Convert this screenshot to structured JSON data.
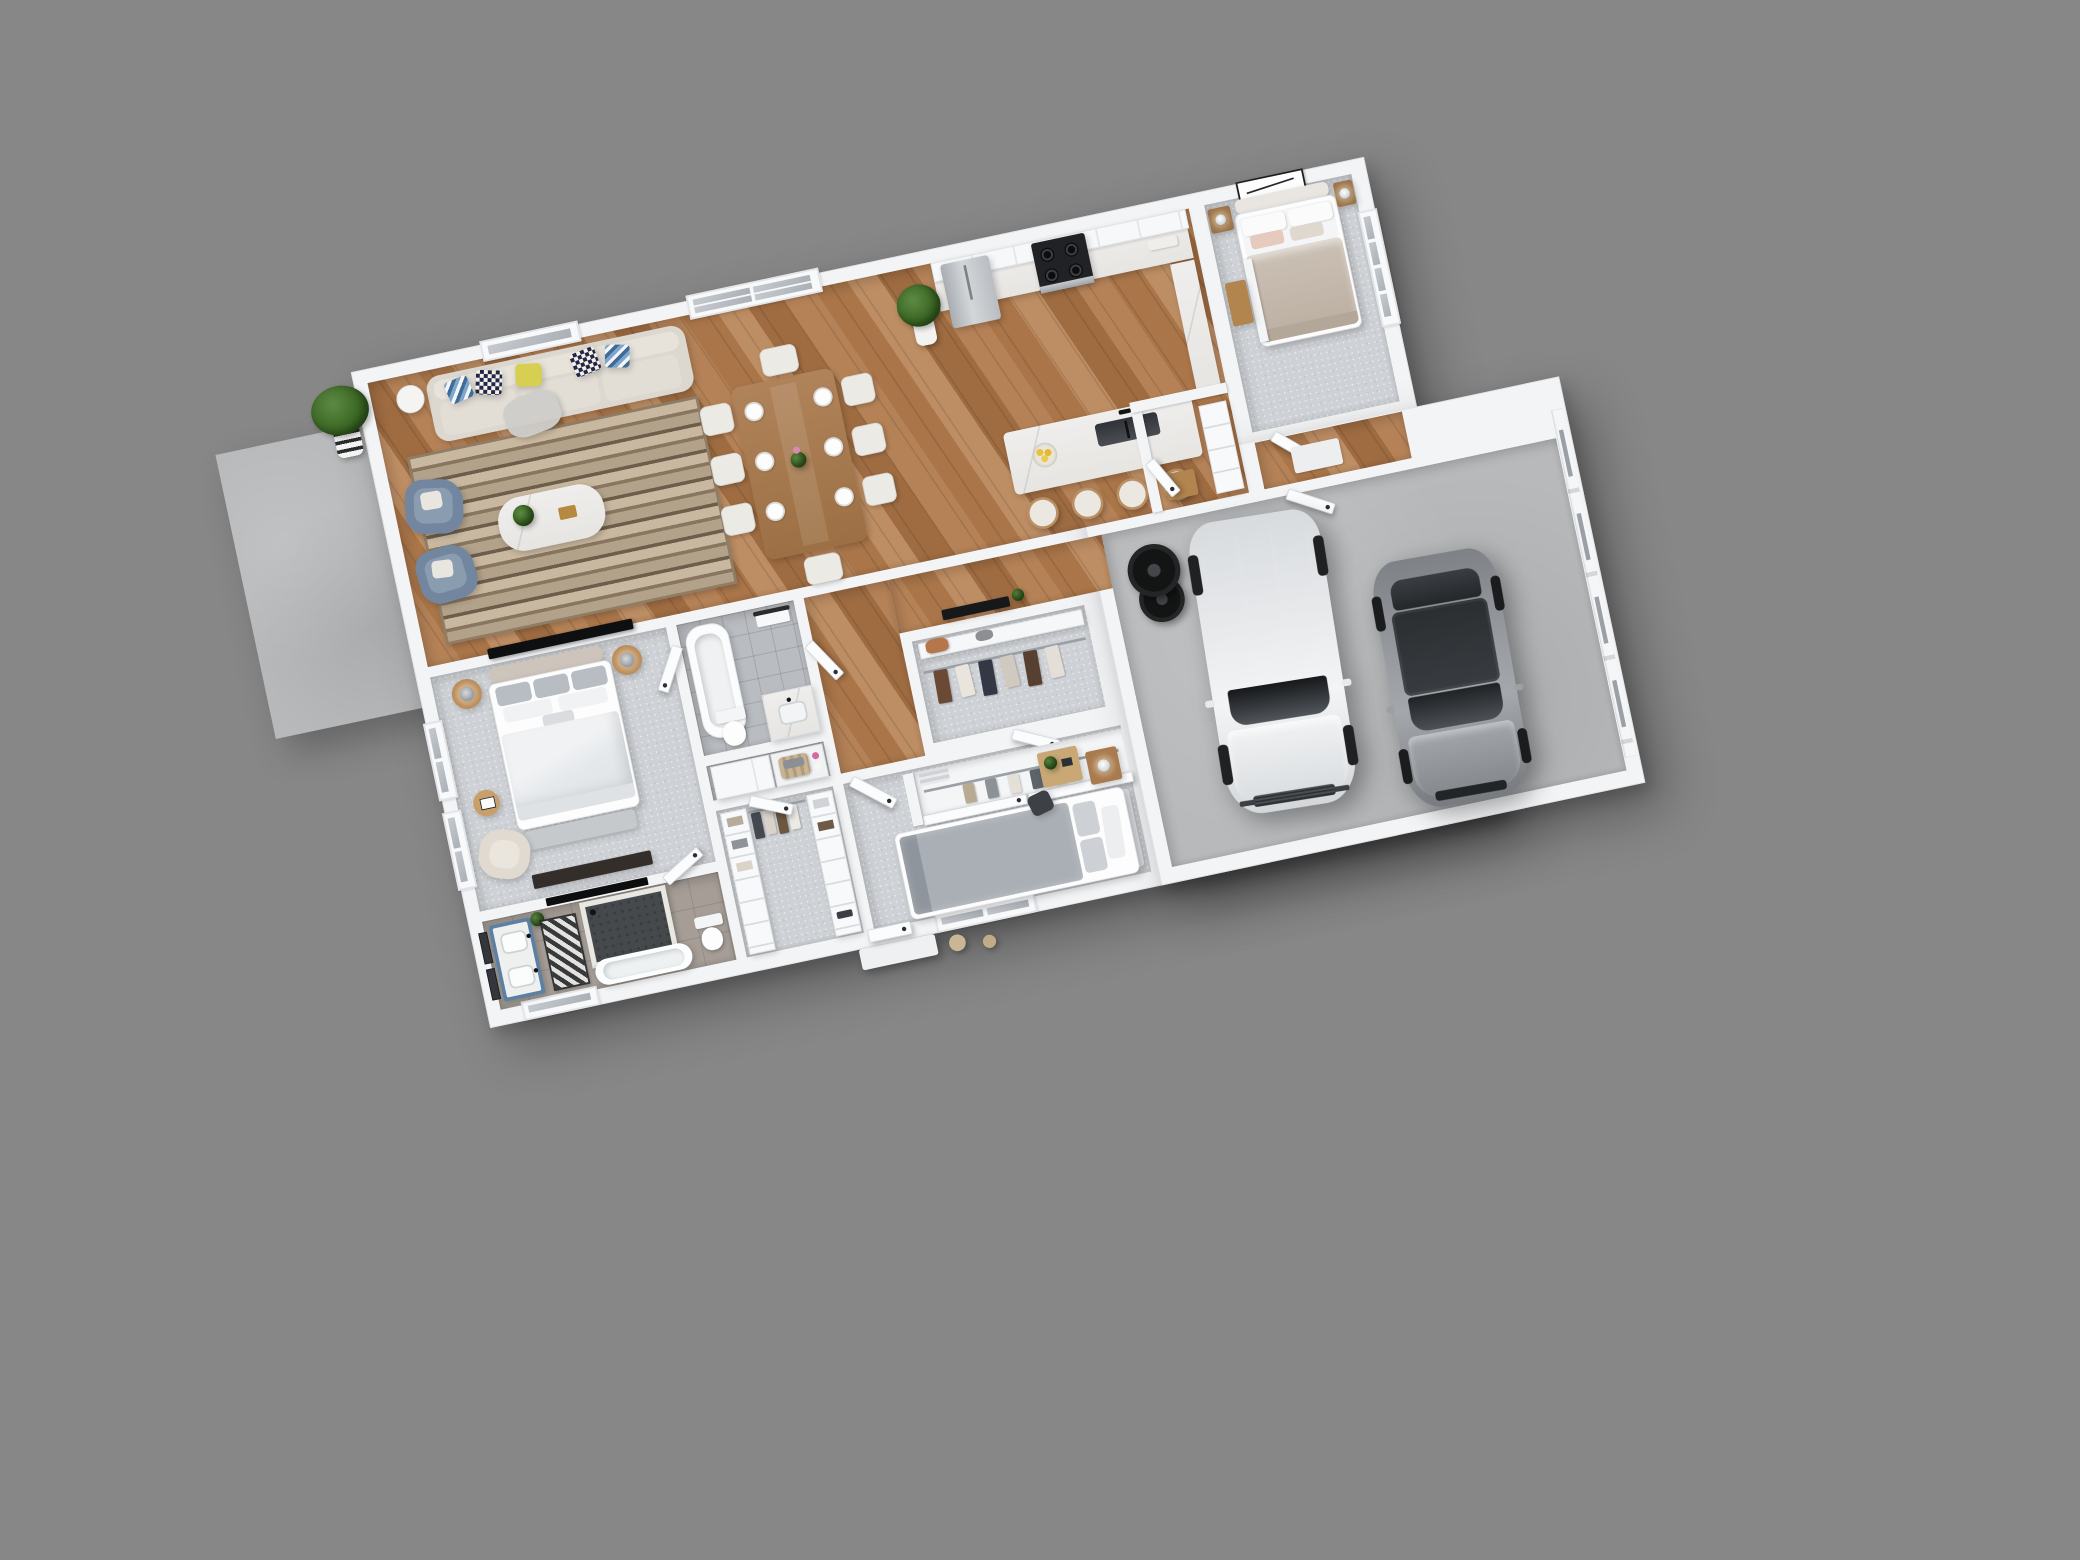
{
  "scene": {
    "type": "3d-floor-plan-render",
    "description": "Photoreal 3D dollhouse floor plan of a single-story 3-bedroom house with attached 2-car garage, viewed from above at a slight counter-clockwise rotation on a plain gray backdrop",
    "rotation_deg": -12,
    "visible_text": ""
  },
  "palette": {
    "background": "#878787",
    "wall": "#f3f4f6",
    "carpet": "#ced1d5",
    "concrete": "#b7b9bb",
    "tile_gray": "#b9bcc0",
    "tile_warm": "#a59d96",
    "wood_floor": "#ad7a4f",
    "marble": "#edecec",
    "sofa_beige": "#dcd8d0",
    "armchair_blue": "#72879f",
    "vanity_blue": "#5c80a4",
    "dining_wood": "#a87c50",
    "pillow_yellow": "#d6cf52",
    "pillow_navy": "#20264a",
    "duvet_beige": "#cbc0b4",
    "duvet_gray": "#a9afb5",
    "suv_white": "#e9ebed",
    "suv_roof_black": "#17181a",
    "sedan_gray": "#96999d"
  },
  "rooms": {
    "patio": {
      "name": "Concrete patio",
      "floor": "concrete"
    },
    "living_room": {
      "name": "Living room",
      "floor": "hardwood"
    },
    "dining_area": {
      "name": "Dining area",
      "floor": "hardwood"
    },
    "kitchen": {
      "name": "Kitchen",
      "floor": "hardwood"
    },
    "pantry": {
      "name": "Pantry / mudroom",
      "floor": "hardwood"
    },
    "bedroom_2": {
      "name": "Bedroom 2",
      "floor": "carpet"
    },
    "entry_hall": {
      "name": "Garage entry hall",
      "floor": "hardwood"
    },
    "hallway": {
      "name": "Hallway",
      "floor": "hardwood"
    },
    "hall_bathroom": {
      "name": "Hall bathroom",
      "floor": "gray tile"
    },
    "coat_closet": {
      "name": "Coat closet",
      "floor": "carpet"
    },
    "laundry_nook": {
      "name": "Laundry nook",
      "floor": "gray tile"
    },
    "master_bedroom": {
      "name": "Master bedroom",
      "floor": "carpet"
    },
    "master_bathroom": {
      "name": "Master bathroom",
      "floor": "warm tile"
    },
    "walk_in_closet": {
      "name": "Walk-in closet",
      "floor": "carpet"
    },
    "bedroom_3": {
      "name": "Bedroom 3",
      "floor": "carpet"
    },
    "garage": {
      "name": "Two-car garage",
      "floor": "concrete"
    }
  },
  "furniture": {
    "living_room": [
      "beige 3-seat sofa with yellow, checkered and zigzag pillows",
      "gray throw blanket",
      "two slate-blue armchairs with white pillows",
      "white marble coffee table with plant and gold box",
      "brown striped area rug",
      "white drum side table",
      "wall-mounted TV",
      "potted plant in striped pot on patio corner"
    ],
    "dining_area": [
      "rectangular wood dining table",
      "8 white upholstered chairs",
      "white place-setting plates",
      "flower vase"
    ],
    "kitchen": [
      "white shaker cabinet run with upper cabinets",
      "stainless french-door refrigerator",
      "stainless gas range with oven",
      "white marble countertops",
      "canister set",
      "marble waterfall island with double sink and black faucet",
      "bowl of lemons",
      "4 white bar stools with wood legs",
      "fiddle-leaf fig plant"
    ],
    "pantry": [
      "white cubby shelving",
      "wood bench"
    ],
    "bedroom_2": [
      "queen bed with beige duvet and blush pillows",
      "two wood nightstands with lamps",
      "black-framed wall art",
      "4-pane window",
      "closet nook with wood bench"
    ],
    "hall_bathroom": [
      "alcove bathtub",
      "towel bar with white towel",
      "white vanity with sink",
      "toilet"
    ],
    "coat_closet": [
      "top shelf with brown purse",
      "hanging rod with coats and shirts"
    ],
    "laundry_nook": [
      "white storage cabinet",
      "counter with woven laundry basket",
      "pink detergent bottle"
    ],
    "hallway": [
      "black console table with plant"
    ],
    "master_bedroom": [
      "king bed with white duvet and gray pillows",
      "upholstered headboard",
      "two round wood nightstands with gray lamps",
      "foot-of-bed bench",
      "dark media dresser with TV",
      "cream armchair",
      "round wood side table with book",
      "two left-wall windows"
    ],
    "master_bathroom": [
      "blue double vanity with white top, two sinks and black faucets",
      "two dark-framed mirrors",
      "walk-in marble shower with dark hex tile",
      "freestanding white tub",
      "toilet",
      "black-and-white patterned runner rug",
      "small plant"
    ],
    "walk_in_closet": [
      "two white shelving towers with folded clothes",
      "center hanging rod with garments",
      "shoes"
    ],
    "bedroom_3": [
      "queen bed with gray duvet",
      "sliding-door closet with hanging clothes and towel shelf",
      "wood nightstand with lamp",
      "wood desk with plant",
      "dark desk chair",
      "bottom-wall window",
      "two beige floor poufs outside window"
    ],
    "garage": [
      "white SUV with black panoramic roof",
      "gray sedan",
      "stack of black spare tires",
      "white entry mat",
      "paneled garage door with 4 window slits"
    ]
  }
}
